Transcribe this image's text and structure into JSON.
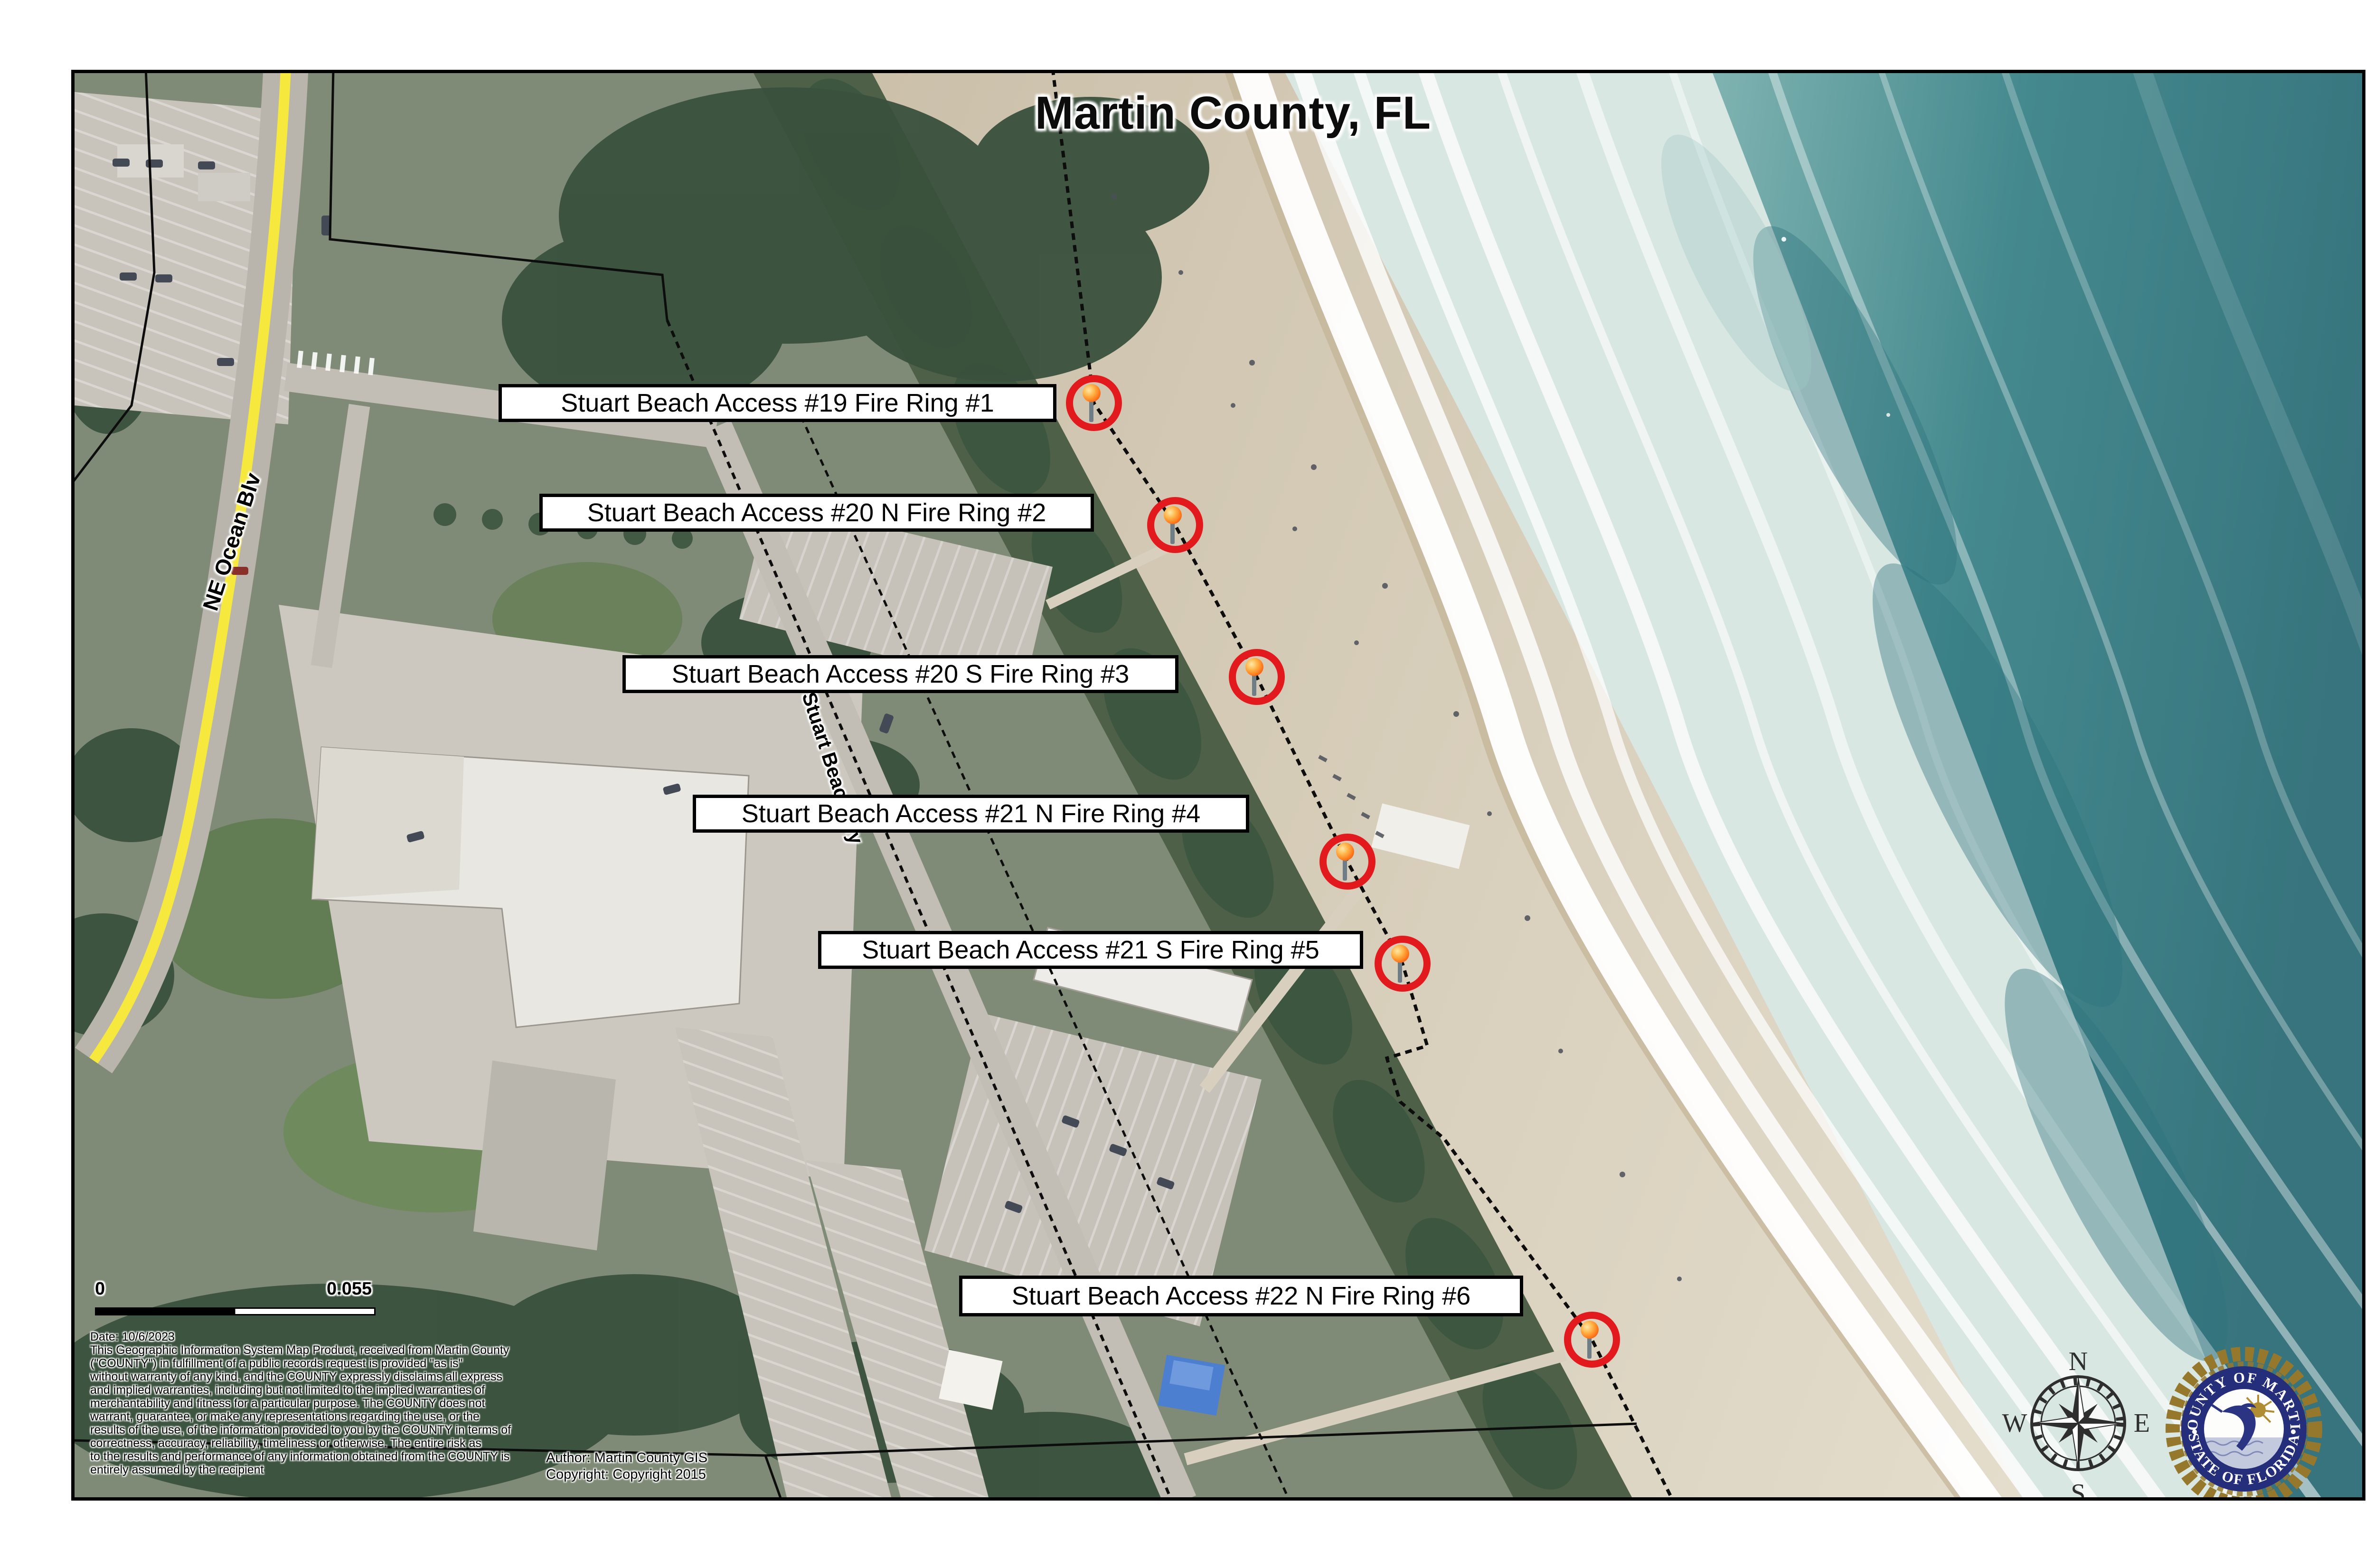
{
  "title": "Martin County, FL",
  "labels": [
    {
      "text": "Stuart Beach Access #19 Fire Ring #1"
    },
    {
      "text": "Stuart Beach Access #20 N Fire Ring #2"
    },
    {
      "text": "Stuart Beach Access #20 S Fire Ring #3"
    },
    {
      "text": "Stuart Beach Access #21 N Fire Ring #4"
    },
    {
      "text": "Stuart Beach Access #21 S Fire Ring #5"
    },
    {
      "text": "Stuart Beach Access #22 N Fire Ring #6"
    }
  ],
  "streets": {
    "ne_ocean_blvd": "NE Ocean Blv",
    "stuart_beach_way": "Stuart Beach Wy"
  },
  "scalebar": {
    "start": "0",
    "end": "0.055"
  },
  "disclaimer": {
    "lines": [
      "Date: 10/6/2023",
      "This Geographic Information System Map Product, received from Martin County",
      "(\"COUNTY\") in fulfillment of a public records request is provided \"as is\"",
      "without warranty of any kind, and the COUNTY expressly disclaims all express",
      "and implied warranties, including but not limited to the implied warranties of",
      "merchantability and fitness for a particular purpose.  The COUNTY does not",
      "warrant, guarantee, or make any representations regarding the use, or the",
      "results of the use, of the information provided to you by the COUNTY in terms of",
      "correctness, accuracy, reliability, timeliness or otherwise.  The entire risk as",
      "to the results and performance of any information obtained from the COUNTY is",
      "entirely assumed by the recipient"
    ]
  },
  "credits": {
    "author": "Author: Martin County GIS",
    "copyright": "Copyright: Copyright 2015"
  },
  "compass": {
    "n": "N",
    "e": "E",
    "s": "S",
    "w": "W"
  },
  "seal": {
    "top": "COUNTY OF MARTIN",
    "bottom": "STATE OF FLORIDA"
  },
  "colors": {
    "marker_ring_red": "#e21a1d",
    "torch_orange": "#ff7a1c",
    "road_yellow": "#f6e83c",
    "ocean_teal": "#44898e",
    "seal_navy": "#252e7a",
    "seal_gold": "#96782c"
  }
}
